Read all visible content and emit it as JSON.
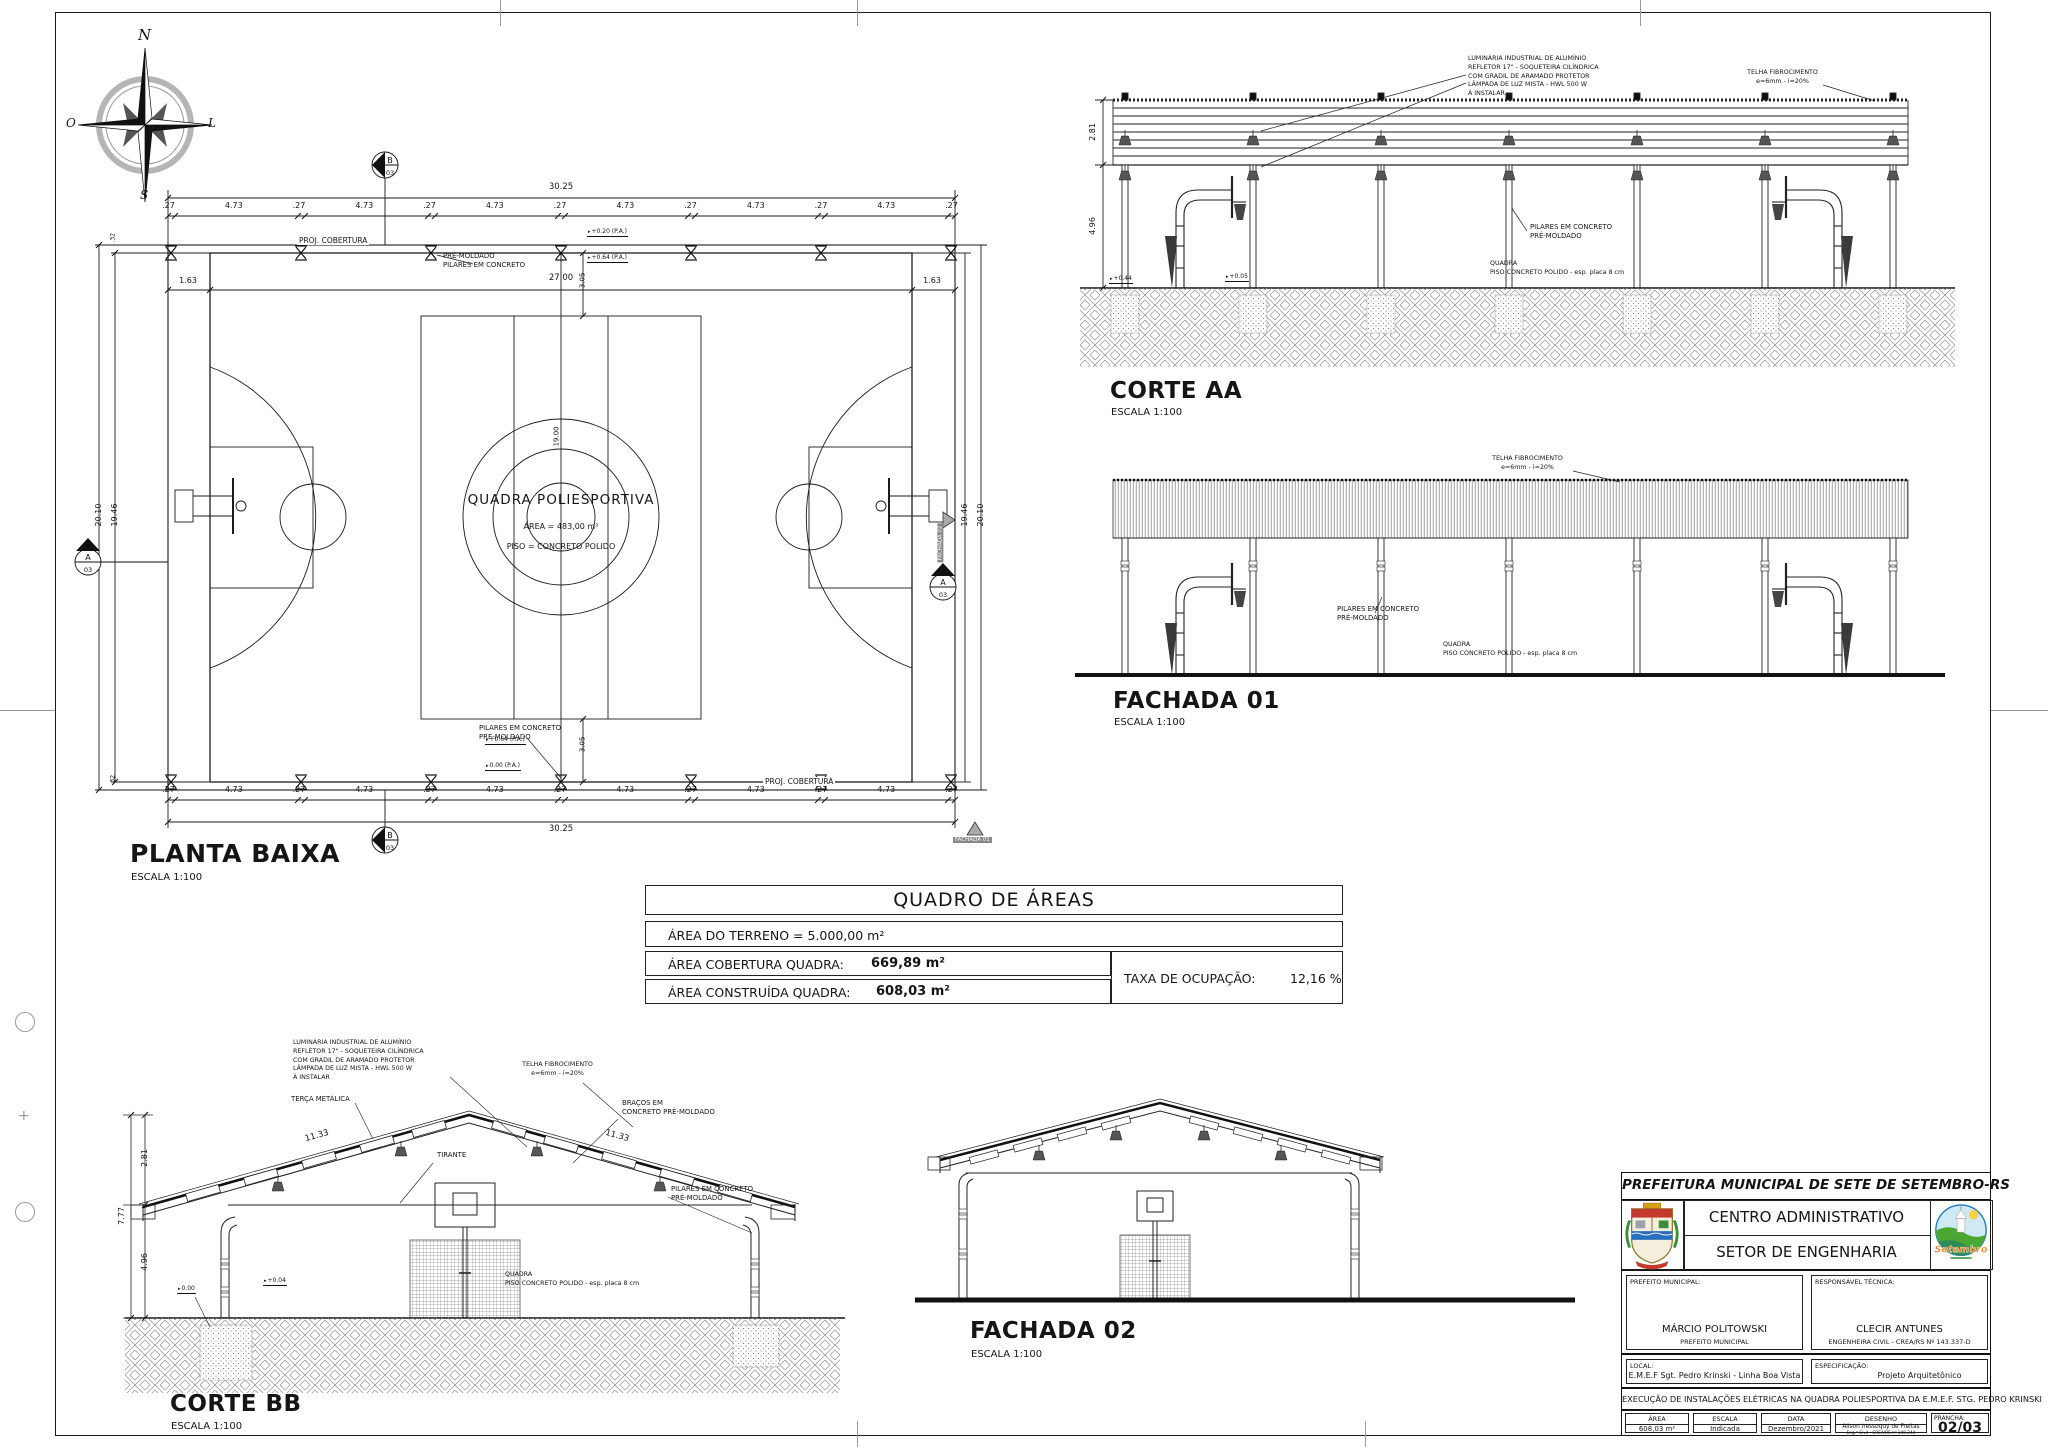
{
  "common": {
    "escala": "ESCALA 1:100",
    "luminaria": [
      "LUMINÁRIA INDUSTRIAL DE ALUMÍNIO",
      "REFLETOR 17\" - SOQUETEIRA CILÍNDRICA",
      "COM GRADIL DE ARAMADO PROTETOR",
      "LÂMPADA DE LUZ MISTA - HWL 500 W",
      "À INSTALAR"
    ],
    "telha": [
      "TELHA FIBROCIMENTO",
      "e=6mm  -  i=20%"
    ],
    "pilares": [
      "PILARES EM CONCRETO",
      "PRÉ-MOLDADO"
    ],
    "pilares_inv": [
      "PRÉ-MOLDADO",
      "PILARES EM CONCRETO"
    ],
    "quadra": [
      "QUADRA",
      "PISO CONCRETO POLIDO - esp. placa 8 cm"
    ]
  },
  "compass": {
    "n": "N",
    "s": "S",
    "o": "O",
    "l": "L"
  },
  "planta": {
    "title": "PLANTA BAIXA",
    "dim_total": "30.25",
    "dims": [
      ".27",
      "4.73",
      ".27",
      "4.73",
      ".27",
      "4.73",
      ".27",
      "4.73",
      ".27",
      "4.73",
      ".27",
      "4.73",
      ".27"
    ],
    "dim_court": "27.00",
    "dim_163_l": "1.63",
    "dim_163_r": "1.63",
    "dim_305_t": "3.05",
    "dim_305_b": "3.05",
    "dim_2010": "20.10",
    "dim_1946": "19.46",
    "dim_19": "19.00",
    "dim_32": ".32",
    "proj_cobertura": "PROJ. COBERTURA",
    "lev_t1": "+0.20 (P.A.)",
    "lev_t2": "+0.64 (P.A.)",
    "lev_b1": "+0.64 (P.A.)",
    "lev_b2": "0.00 (P.A.)",
    "court_name": "QUADRA POLIESPORTIVA",
    "court_area": "ÁREA = 483,00 m²",
    "court_piso": "PISO = CONCRETO POLIDO",
    "marker_a": "A",
    "marker_b": "B",
    "marker_sheet": "03",
    "fachada01": "FACHADA 01",
    "fachada02": "FACHADA 02"
  },
  "corte_aa": {
    "title": "CORTE AA",
    "dim_281": "2.81",
    "dim_496": "4.96",
    "lev1": "+0.44",
    "lev2": "+0.05"
  },
  "fachada01": {
    "title": "FACHADA 01"
  },
  "corte_bb": {
    "title": "CORTE BB",
    "dim_281": "2.81",
    "dim_777": "7.77",
    "dim_496": "4.96",
    "dim_1133_l": "11.33",
    "dim_1133_r": "11.33",
    "terca": "TERÇA METÁLICA",
    "tirante": "TIRANTE",
    "bracos": [
      "BRAÇOS EM",
      "CONCRETO PRÉ-MOLDADO"
    ],
    "lev1": "0.00",
    "lev2": "+0.04"
  },
  "fachada02": {
    "title": "FACHADA 02"
  },
  "quadro": {
    "title": "QUADRO DE ÁREAS",
    "terreno": "ÁREA DO TERRENO =  5.000,00 m²",
    "cobertura_label": "ÁREA COBERTURA QUADRA:",
    "cobertura_value": "669,89 m²",
    "construida_label": "ÁREA CONSTRUÍDA QUADRA:",
    "construida_value": "608,03 m²",
    "taxa_label": "TAXA DE OCUPAÇÃO:",
    "taxa_value": "12,16 %"
  },
  "titleblock": {
    "header": "PREFEITURA MUNICIPAL DE SETE DE SETEMBRO-RS",
    "line1": "CENTRO ADMINISTRATIVO",
    "line2": "SETOR DE ENGENHARIA",
    "prefeito_label": "PREFEITO MUNICIPAL:",
    "prefeito_nome": "MÁRCIO POLITOWSKI",
    "prefeito_cargo": "PREFEITO MUNICIPAL",
    "resp_label": "RESPONSÁVEL TÉCNICA:",
    "resp_nome": "CLECIR ANTUNES",
    "resp_titulo": "ENGENHEIRA CIVIL - CREA/RS Nº 143.337-D",
    "local_label": "LOCAL:",
    "local_value": "E.M.E.F Sgt. Pedro Krinski - Linha Boa Vista",
    "espec_label": "ESPECIFICAÇÃO:",
    "espec_value": "Projeto Arquitetônico",
    "descricao": "EXECUÇÃO DE INSTALAÇÕES ELÉTRICAS NA QUADRA POLIESPORTIVA DA E.M.E.F. STG. PEDRO KRINSKI",
    "area_label": "ÁREA",
    "area_value": "608,03 m²",
    "escala_label": "ESCALA",
    "escala_value": "Indicada",
    "data_label": "DATA",
    "data_value": "Dezembro/2021",
    "desenho_label": "DESENHO",
    "desenho_nome": "Alison Iressoquy de Freitas",
    "desenho_titulo": "Eng.º Civil - CREA/RS nº 248.244",
    "prancha_label": "PRANCHA:",
    "prancha_value": "02/03",
    "logo_text": "Setembro"
  }
}
